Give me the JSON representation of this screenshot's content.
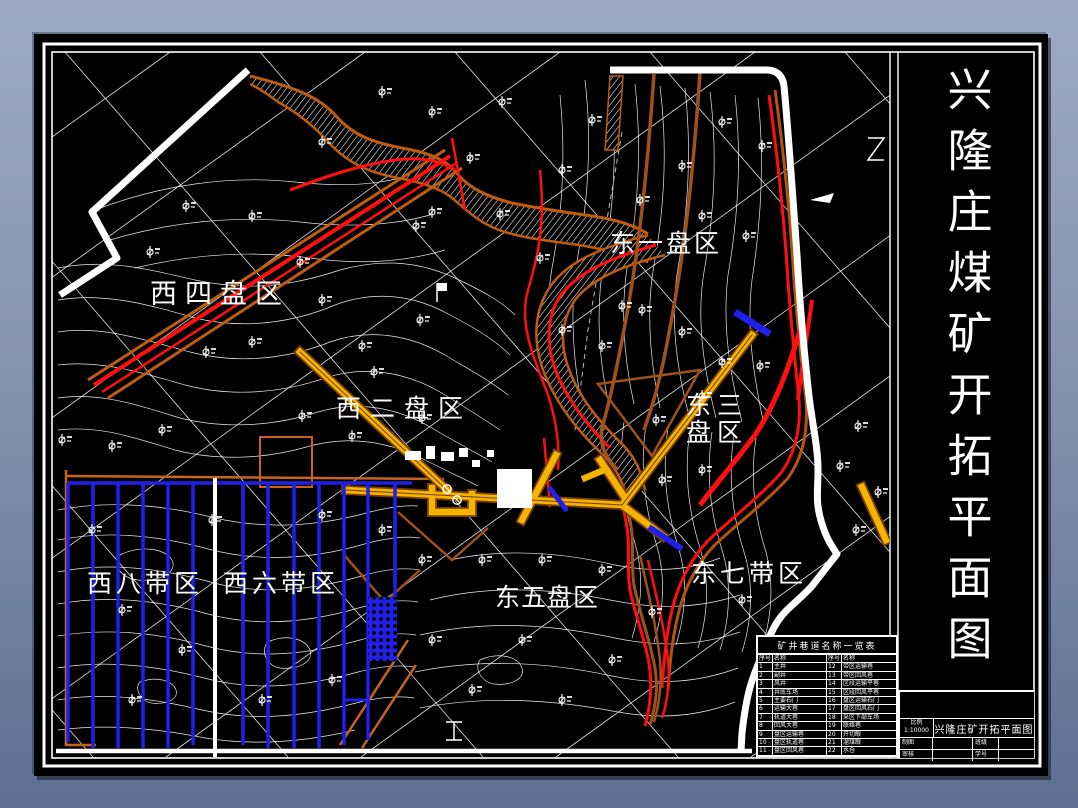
{
  "page": {
    "background_top": "#9aabc4",
    "background_bottom": "#5d7091"
  },
  "drawing": {
    "side_title": "兴隆庄煤矿开拓平面图",
    "districts": {
      "west4": "西四盘区",
      "east1": "东一盘区",
      "west2": "西二盘区",
      "east3_line1": "东三",
      "east3_line2": "盘区",
      "west8": "西八带区",
      "west6": "西六带区",
      "east5": "东五盘区",
      "east7": "东七带区"
    },
    "colors": {
      "sheet": "#000000",
      "frame": "#ffffff",
      "grid": "#ffffff",
      "contour": "#ffffff",
      "boundary": "#ffffff",
      "roadway_fill": "#f5b400",
      "roadway_casing": "#8a4a0a",
      "outcrop_orange": "#c05c10",
      "fault_red": "#ff0f0f",
      "panel_blue": "#2020ea"
    }
  },
  "legend": {
    "title": "矿井巷道名称一览表",
    "rows": [
      {
        "n1": "序号",
        "m1": "名称",
        "n2": "序号",
        "m2": "名称"
      },
      {
        "n1": "1",
        "m1": "主井",
        "n2": "12",
        "m2": "带区运输巷"
      },
      {
        "n1": "2",
        "m1": "副井",
        "n2": "13",
        "m2": "带区回风巷"
      },
      {
        "n1": "3",
        "m1": "风井",
        "n2": "14",
        "m2": "区段运输平巷"
      },
      {
        "n1": "4",
        "m1": "井底车场",
        "n2": "15",
        "m2": "区段回风平巷"
      },
      {
        "n1": "5",
        "m1": "主要石门",
        "n2": "16",
        "m2": "盘区运输石门"
      },
      {
        "n1": "6",
        "m1": "运输大巷",
        "n2": "17",
        "m2": "盘区回风石门"
      },
      {
        "n1": "7",
        "m1": "轨道大巷",
        "n2": "18",
        "m2": "采区下部车场"
      },
      {
        "n1": "8",
        "m1": "回风大巷",
        "n2": "19",
        "m2": "联络巷"
      },
      {
        "n1": "9",
        "m1": "盘区运输巷",
        "n2": "20",
        "m2": "开切眼"
      },
      {
        "n1": "10",
        "m1": "盘区轨道巷",
        "n2": "21",
        "m2": "溜煤眼"
      },
      {
        "n1": "11",
        "m1": "盘区回风巷",
        "n2": "22",
        "m2": "水仓"
      }
    ]
  },
  "title_block": {
    "scale_label": "比例",
    "scale_value": "1:10000",
    "drawing_title": "兴隆庄矿开拓平面图",
    "drafter_label": "制图",
    "checker_label": "审核",
    "class_label": "班级",
    "number_label": "学号"
  }
}
